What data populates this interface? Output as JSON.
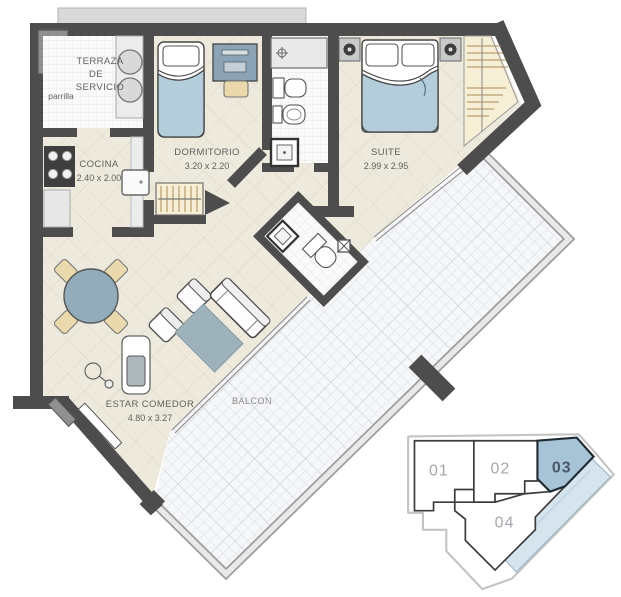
{
  "plan": {
    "type": "apartment-floor-plan",
    "rooms": {
      "terraza": {
        "line1": "TERRAZA",
        "line2": "DE",
        "line3": "SERVICIO",
        "note": "parrilla"
      },
      "cocina": {
        "name": "COCINA",
        "dims": "2.40 x 2.00"
      },
      "dormitorio": {
        "name": "DORMITORIO",
        "dims": "3.20 x 2.20"
      },
      "suite": {
        "name": "SUITE",
        "dims": "2.99 x 2.95"
      },
      "estar": {
        "name": "ESTAR COMEDOR",
        "dims": "4.80 x 3.27"
      },
      "balcon": {
        "name": "BALCON"
      }
    },
    "colors": {
      "wall": "#4d4d4d",
      "floor": "#edeadd",
      "tile_line": "#dcd6c4",
      "balcony_floor": "#f6f7f9",
      "bed_blue": "#b3cdda",
      "furniture_bluegray": "#8ba3b5",
      "rug": "#9db2ba",
      "chair_beige": "#ead9ad",
      "closet_beige": "#f7eed6",
      "unit_highlight": "#a7c3d6",
      "unit_balcony_highlight": "#d6e4ee"
    }
  },
  "locator": {
    "selected": "03",
    "units": [
      {
        "id": "01",
        "selected": false
      },
      {
        "id": "02",
        "selected": false
      },
      {
        "id": "03",
        "selected": true
      },
      {
        "id": "04",
        "selected": false
      }
    ]
  }
}
